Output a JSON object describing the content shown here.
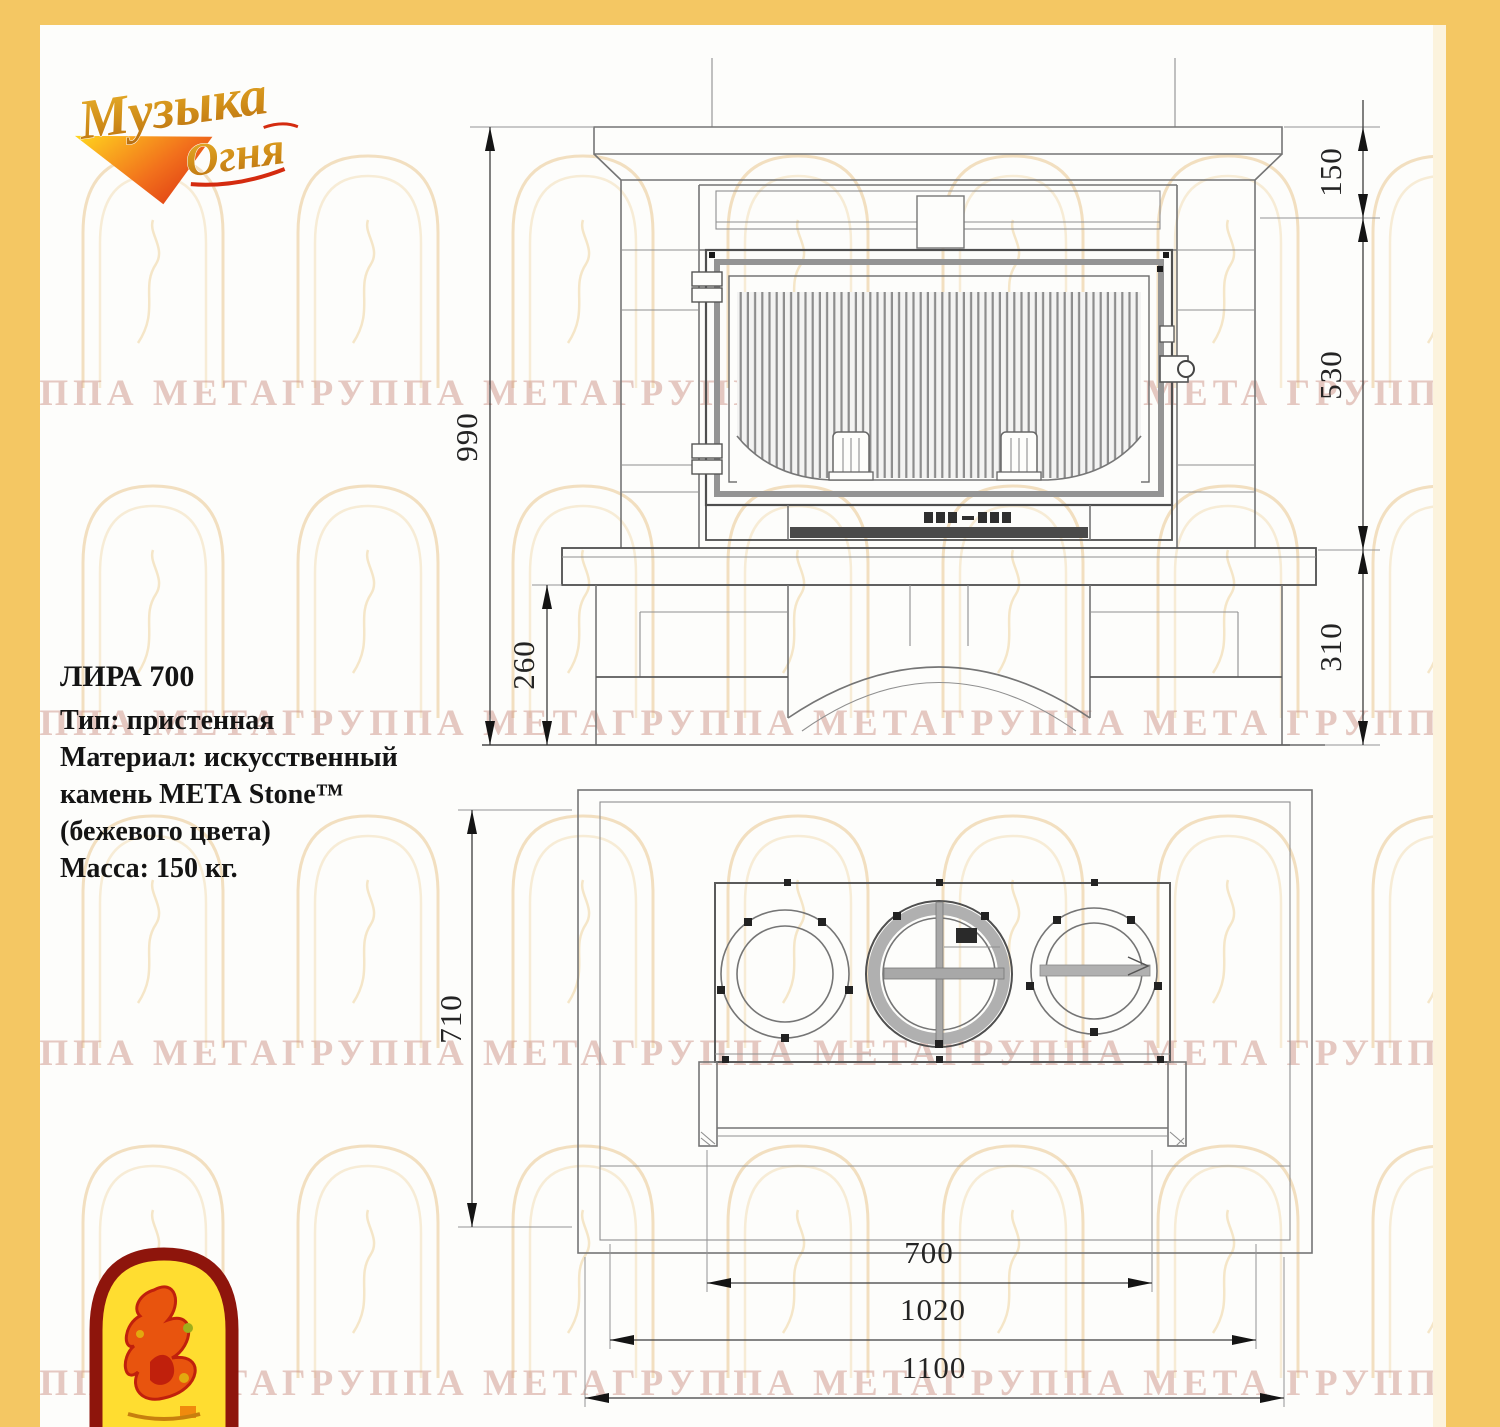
{
  "brand": {
    "logo_line1": "Музыка",
    "logo_line2": "Огня"
  },
  "watermark": {
    "text": "ГРУППА МЕТАГРУППА МЕТАГРУППА МЕТАГРУППА МЕТА ГРУППА МЕТА"
  },
  "product": {
    "name": "ЛИРА 700",
    "type_line": "Тип: пристенная",
    "material_line1": "Материал: искусственный",
    "material_line2": "камень МЕТА Stone™",
    "material_line3": "(бежевого цвета)",
    "mass_line": "Масса: 150 кг."
  },
  "drawing": {
    "front_view": {
      "dims": {
        "height_total": "990",
        "pedestal_height_left": "260",
        "mantel_height": "150",
        "firebox_height": "530",
        "base_height_right": "310"
      }
    },
    "top_view": {
      "dims": {
        "depth": "710",
        "firebox_width": "700",
        "inner_width": "1020",
        "total_width": "1100"
      }
    }
  },
  "colors": {
    "border": "#f4c763",
    "line": "#757575",
    "dim_text": "#242424",
    "watermark_arch": "#f2dfc0",
    "watermark_text": "#ce9488"
  }
}
